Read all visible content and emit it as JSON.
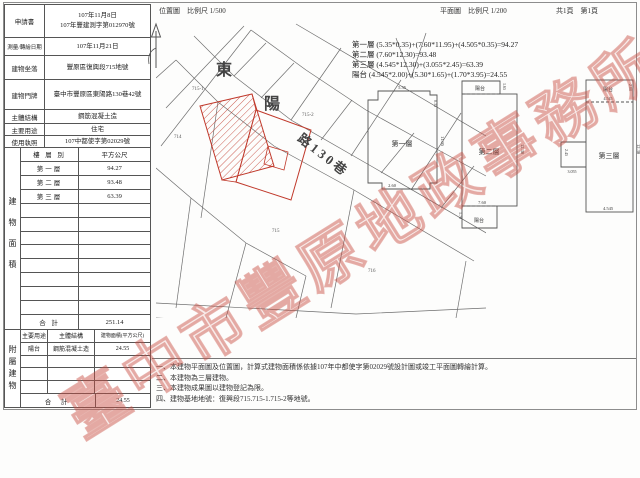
{
  "header": {
    "location_scale": "位置圖　比例尺 1/500",
    "plan_scale": "平面圖　比例尺 1/200",
    "pages": "共1頁　第1頁"
  },
  "info": {
    "rows": [
      {
        "label": "申請書",
        "value": "107年11月8日\n107年豐建測字第012970號"
      },
      {
        "label": "測量/轉繪日期",
        "value": "107年11月21日"
      },
      {
        "label": "建物坐落",
        "value": "豐原區復興段715地號"
      },
      {
        "label": "建物門牌",
        "value": "臺中市豐原區東陽路130巷42號"
      },
      {
        "label": "主體結構",
        "value": "鋼筋混凝土造"
      },
      {
        "label": "主要用途",
        "value": "住宅"
      },
      {
        "label": "使用執照",
        "value": "107中都使字第02029號"
      }
    ]
  },
  "area": {
    "side_label": "建物面積",
    "col_floor": "樓 層 別",
    "col_area": "平方公尺",
    "rows": [
      {
        "floor": "第一層",
        "area": "94.27"
      },
      {
        "floor": "第二層",
        "area": "93.48"
      },
      {
        "floor": "第三層",
        "area": "63.39"
      }
    ],
    "empty_rows": 8,
    "total_label": "合 計",
    "total": "251.14"
  },
  "annex": {
    "side_label": "附屬建物",
    "h_use": "主要用途",
    "h_structure": "主體結構",
    "h_area": "建物面積(平方公尺)",
    "rows": [
      {
        "use": "陽台",
        "structure": "鋼筋混凝土造",
        "area": "24.55"
      }
    ],
    "empty_rows": 3,
    "total_label": "合 計",
    "total": "24.55"
  },
  "calc": {
    "lines": [
      "第一層 (5.35*0.35)+(7.60*11.95)+(4.505*0.35)=94.27",
      "第二層 (7.60*12.30)=93.48",
      "第三層 (4.545*12.30)+(3.055*2.45)=63.39",
      "陽台 (4.545*2.00)+(5.30*1.65)+(1.70*3.95)=24.55"
    ]
  },
  "map": {
    "road": [
      "東",
      "陽",
      "路130巷"
    ],
    "parcels": [
      "714",
      "715-1",
      "715-2",
      "715",
      "716"
    ]
  },
  "plans": {
    "p1": {
      "label": "第一層",
      "dim_top": "5.35",
      "dim_top_right": "0.35",
      "dim_right": "11.95",
      "dim_bottom": "2.60"
    },
    "p2": {
      "label": "第二層",
      "balcony": "陽台",
      "dim_balcony_right": "1.65",
      "dim_right": "12.30",
      "dim_bottom": "7.60",
      "balcony2": "陽台",
      "dim_balcony2_left": "1.70"
    },
    "p3": {
      "label": "第三層",
      "balcony": "陽台",
      "dim_top": "4.545",
      "dim_top_right": "2.00",
      "dim_right": "12.30",
      "dim_notch": "3.055",
      "dim_notch_side": "2.45",
      "dim_bottom": "4.545"
    }
  },
  "notes": [
    "一、本建物平面圖及位置圖，計算式建物面積係依據107年中都使字第02029號設計圖或竣工平面圖轉繪計算。",
    "二、本建物為三層建物。",
    "三、本建物成果圖以建物登記為限。",
    "四、建物基地地號：復興段715.715-1.715-2等地號。"
  ],
  "watermark": {
    "text": "臺中市豐原地政事務所",
    "color": "#c94f43"
  },
  "colors": {
    "building_outline": "#c0392b",
    "map_line": "#666666",
    "table_line": "#555555"
  }
}
